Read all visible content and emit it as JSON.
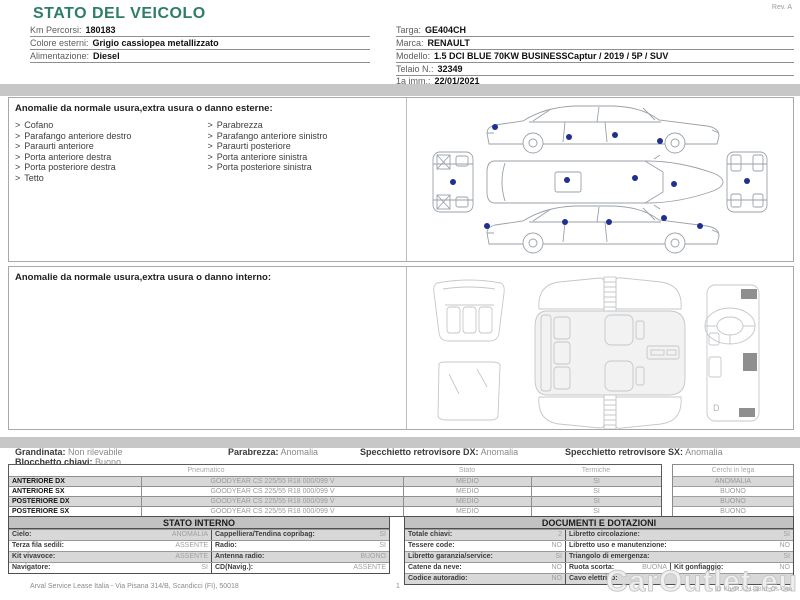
{
  "page": {
    "rev": "Rev. A",
    "watermark": "CarOutlet.eu",
    "footer": {
      "company": "Arval Service Lease Italia - Via Pisana 314/B, Scandicci (FI), 50018",
      "page_number": "1",
      "doc_id": "ID Ku/IRJ-21-a8Id ;Os-04u"
    }
  },
  "header": {
    "title": "STATO DEL VEICOLO",
    "left_fields": [
      {
        "label": "Km Percorsi:",
        "value": "180183"
      },
      {
        "label": "Colore esterni:",
        "value": "Grigio cassiopea metallizzato"
      },
      {
        "label": "Alimentazione:",
        "value": "Diesel"
      }
    ],
    "right_fields": [
      {
        "label": "Targa:",
        "value": "GE404CH"
      },
      {
        "label": "Marca:",
        "value": "RENAULT"
      },
      {
        "label": "Modello:",
        "value": "1.5 DCI BLUE 70KW BUSINESSCaptur / 2019 / 5P / SUV"
      },
      {
        "label": "Telaio N.:",
        "value": "32349"
      },
      {
        "label": "1a imm.:",
        "value": "22/01/2021"
      }
    ]
  },
  "exterior_section": {
    "title": "Anomalie da normale usura,extra usura o danno esterne:",
    "bullet": ">",
    "items_col1": [
      "Cofano",
      "Parafango anteriore destro",
      "Paraurti anteriore",
      "Porta anteriore destra",
      "Porta posteriore destra",
      "Tetto"
    ],
    "items_col2": [
      "Parabrezza",
      "Parafango anteriore sinistro",
      "Paraurti posteriore",
      "Porta anteriore sinistra",
      "Porta posteriore sinistra"
    ]
  },
  "interior_section": {
    "title": "Anomalie da normale usura,extra usura o danno interno:",
    "dashboard_label": "D"
  },
  "summary": {
    "grandinata": {
      "label": "Grandinata:",
      "value": "Non rilevabile"
    },
    "parabrezza": {
      "label": "Parabrezza:",
      "value": "Anomalia"
    },
    "specchietto_dx": {
      "label": "Specchietto retrovisore DX:",
      "value": "Anomalia"
    },
    "specchietto_sx": {
      "label": "Specchietto retrovisore SX:",
      "value": "Anomalia"
    },
    "blocchetto": {
      "label": "Blocchetto chiavi:",
      "value": "Buono"
    }
  },
  "tires": {
    "headers": {
      "pneumatico": "Pneumatico",
      "stato": "Stato",
      "termiche": "Termiche",
      "cerchi": "Cerchi in lega"
    },
    "rows": [
      {
        "position": "ANTERIORE DX",
        "pneumatico": "GOODYEAR CS 225/55 R18 000/099 V",
        "stato": "MEDIO",
        "termiche": "SI",
        "cerchi": "ANOMALIA"
      },
      {
        "position": "ANTERIORE SX",
        "pneumatico": "GOODYEAR CS 225/55 R18 000/099 V",
        "stato": "MEDIO",
        "termiche": "SI",
        "cerchi": "BUONO"
      },
      {
        "position": "POSTERIORE DX",
        "pneumatico": "GOODYEAR CS 225/55 R18 000/099 V",
        "stato": "MEDIO",
        "termiche": "SI",
        "cerchi": "BUONO"
      },
      {
        "position": "POSTERIORE SX",
        "pneumatico": "GOODYEAR CS 225/55 R18 000/099 V",
        "stato": "MEDIO",
        "termiche": "SI",
        "cerchi": "BUONO"
      }
    ]
  },
  "stato_interno": {
    "title": "STATO INTERNO",
    "rows": [
      {
        "l1": "Cielo:",
        "v1": "ANOMALIA",
        "l2": "Cappelliera/Tendina copribag:",
        "v2": "SI"
      },
      {
        "l1": "Terza fila sedili:",
        "v1": "ASSENTE",
        "l2": "Radio:",
        "v2": "SI"
      },
      {
        "l1": "Kit vivavoce:",
        "v1": "ASSENTE",
        "l2": "Antenna radio:",
        "v2": "BUONO"
      },
      {
        "l1": "Navigatore:",
        "v1": "SI",
        "l2": "CD(Navig.):",
        "v2": "ASSENTE"
      }
    ]
  },
  "documenti": {
    "title": "DOCUMENTI E DOTAZIONI",
    "rows": [
      {
        "l1": "Totale chiavi:",
        "v1": "2",
        "l2": "Libretto circolazione:",
        "v2": "SI"
      },
      {
        "l1": "Tessere code:",
        "v1": "NO",
        "l2": "Libretto uso e manutenzione:",
        "v2": "NO"
      },
      {
        "l1": "Libretto garanzia/service:",
        "v1": "SI",
        "l2": "Triangolo di emergenza:",
        "v2": "SI"
      },
      {
        "l1": "Catene da neve:",
        "v1": "NO",
        "l2": "Ruota scorta:",
        "v2": "BUONA",
        "l3": "Kit gonfiaggio:",
        "v3": "NO"
      },
      {
        "l1": "Codice autoradio:",
        "v1": "NO",
        "l2": "Cavo elettrico:",
        "v2": ""
      }
    ]
  },
  "colors": {
    "accent_teal": "#2e7d68",
    "damage_dot": "#20308e",
    "bar_gray": "#c7c7c7"
  }
}
